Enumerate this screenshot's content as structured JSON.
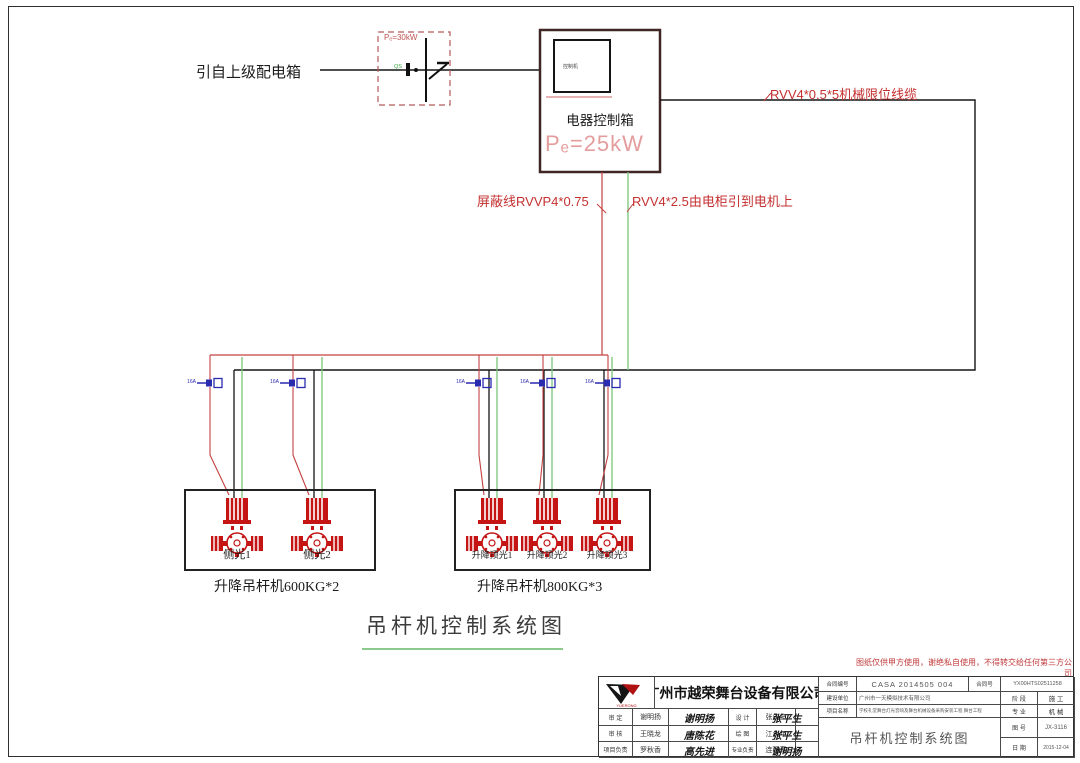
{
  "diagram": {
    "source_label": "引自上级配电箱",
    "breaker_box": {
      "power": "Pₑ=30kW",
      "tag": "QS"
    },
    "control_box": {
      "inner_label": "控制机",
      "name": "电器控制箱",
      "power": "Pₑ=25kW"
    },
    "cable_labels": {
      "limit": "RVV4*0.5*5机械限位线缆",
      "shield": "屏蔽线RVVP4*0.75",
      "motor": "RVV4*2.5由电柜引到电机上"
    },
    "connector_label": "16A",
    "left_group": {
      "motors": [
        "侧光1",
        "侧光2"
      ],
      "caption": "升降吊杆机600KG*2"
    },
    "right_group": {
      "motors": [
        "升降顶光1",
        "升降顶光2",
        "升降顶光3"
      ],
      "caption": "升降吊杆机800KG*3"
    },
    "main_title": "吊杆机控制系统图"
  },
  "title_block": {
    "disclaimer": "图纸仅供甲方使用，谢绝私自使用，不得转交给任何第三方公司",
    "logo_text": "YUERONG",
    "company": "广州市越荣舞台设备有限公司",
    "contract_label": "合同编号",
    "contract_value": "CASA 2014505 004",
    "serial_label": "合同号",
    "serial_value": "YX00HTS02511258",
    "client_label": "建设单位",
    "client_value": "广州市一天模拟技术有限公司",
    "project_label": "项目名称",
    "project_value": "学校礼堂舞台灯光音响及舞台机械设备采购安装工程 舞台工程",
    "stage_label": "阶 段",
    "stage_value": "施 工",
    "major_label": "专 业",
    "major_value": "机 械",
    "figno_label": "图 号",
    "figno_value": "JX-3116",
    "date_label": "日 期",
    "date_value": "2015-12-04",
    "block_title": "吊杆机控制系统图",
    "rows": [
      {
        "l1": "审 定",
        "n1": "谢明扬",
        "s1": "谢明扬",
        "l2": "设 计",
        "n2": "张先生",
        "s2": "张平生"
      },
      {
        "l1": "审 核",
        "n1": "王晓龙",
        "s1": "唐陈花",
        "l2": "绘 图",
        "n2": "江大年",
        "s2": "张平生"
      },
      {
        "l1": "项目负责",
        "n1": "罗秋香",
        "s1": "高先进",
        "l2": "专业负责",
        "n2": "连理真",
        "s2": "谢明扬"
      }
    ]
  }
}
